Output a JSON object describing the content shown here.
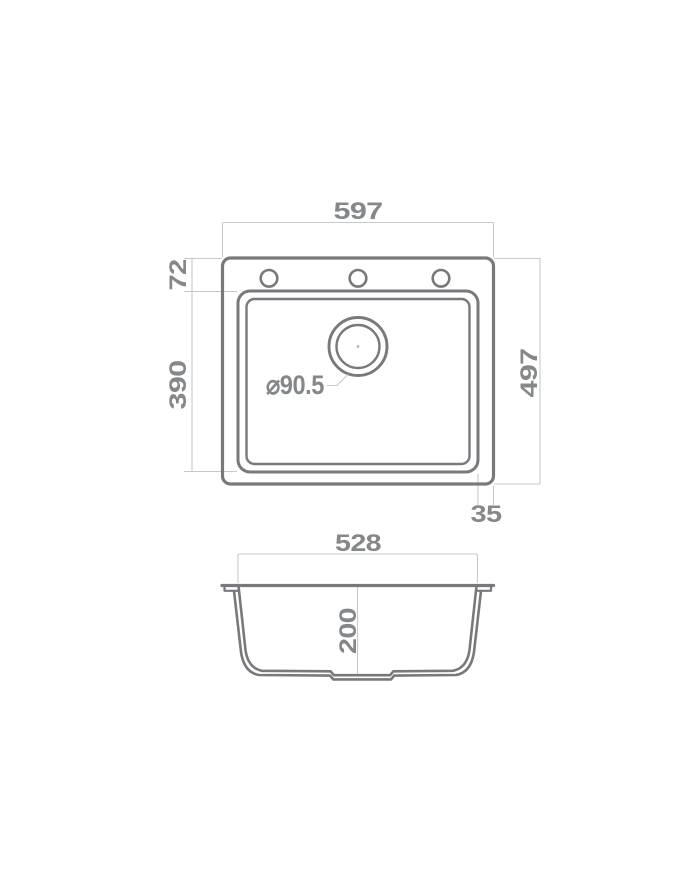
{
  "meta": {
    "type": "technical-drawing",
    "subject": "kitchen sink dimension diagram",
    "views": [
      "top view",
      "front section view"
    ]
  },
  "colors": {
    "outline": "#77797c",
    "dimension_line": "#c7c9cb",
    "text": "#85888b",
    "background": "#ffffff"
  },
  "top_view": {
    "faucet_hole_count": 3,
    "dims": {
      "overall_width": "597",
      "overall_depth": "497",
      "rim_to_bowl_top": "72",
      "bowl_depth": "390",
      "bowl_to_edge_side": "35",
      "drain_diameter": "⌀90.5"
    }
  },
  "section_view": {
    "dims": {
      "bowl_width": "528",
      "bowl_height": "200"
    }
  }
}
